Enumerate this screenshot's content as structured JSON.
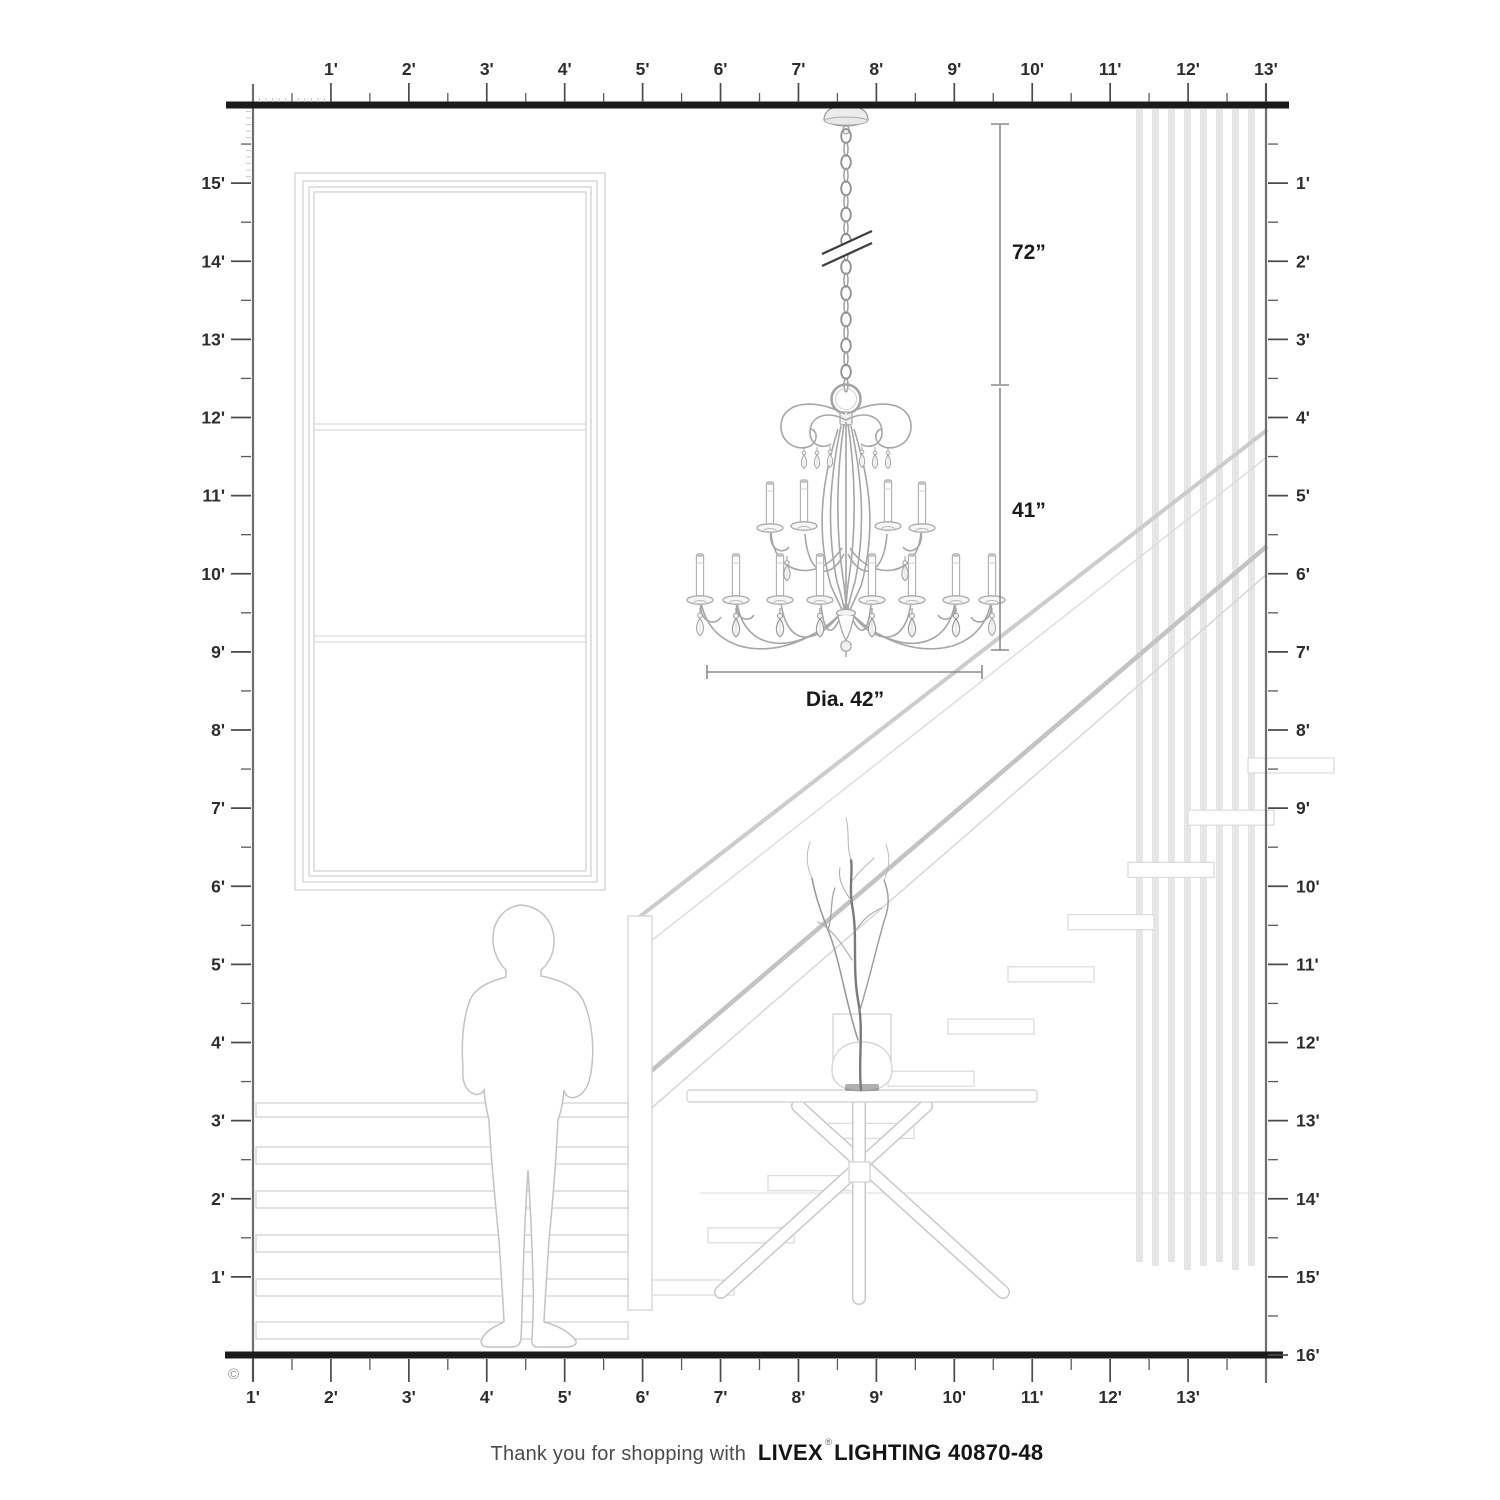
{
  "page": {
    "background": "#ffffff"
  },
  "rulers": {
    "top": {
      "labels": [
        "1'",
        "2'",
        "3'",
        "4'",
        "5'",
        "6'",
        "7'",
        "8'",
        "9'",
        "10'",
        "11'",
        "12'",
        "13'"
      ]
    },
    "left": {
      "labels": [
        "15'",
        "14'",
        "13'",
        "12'",
        "11'",
        "10'",
        "9'",
        "8'",
        "7'",
        "6'",
        "5'",
        "4'",
        "3'",
        "2'",
        "1'"
      ]
    },
    "right": {
      "labels": [
        "1'",
        "2'",
        "3'",
        "4'",
        "5'",
        "6'",
        "7'",
        "8'",
        "9'",
        "10'",
        "11'",
        "12'",
        "13'",
        "14'",
        "15'",
        "16'"
      ]
    },
    "bottom": {
      "labels": [
        "13'",
        "12'",
        "11'",
        "10'",
        "9'",
        "8'",
        "7'",
        "6'",
        "5'",
        "4'",
        "3'",
        "2'",
        "1'"
      ]
    }
  },
  "diagram": {
    "dimensions": {
      "hanging_height": "72”",
      "fixture_height": "41”",
      "diameter": "Dia. 42”"
    }
  },
  "copyright_symbol": "©",
  "footer": {
    "prefix": "Thank you for shopping with",
    "brand": "LIVEX",
    "registered": "®",
    "suffix": "LIGHTING 40870-48"
  },
  "colors": {
    "frame": "#1b1b1b",
    "ruler_line": "#6e6e6e",
    "tick": "#4a4a4a",
    "tick_minor": "#c9c9c9",
    "label": "#2d2d2d",
    "dimension_line": "#8c8c8c",
    "dimension_text": "#1a1a1a",
    "scene": "#d6d6d6",
    "scene_light": "#e6e6e6",
    "chandelier": "#a6a6a6",
    "footer_text": "#4b4b4b",
    "footer_brand": "#151515"
  }
}
